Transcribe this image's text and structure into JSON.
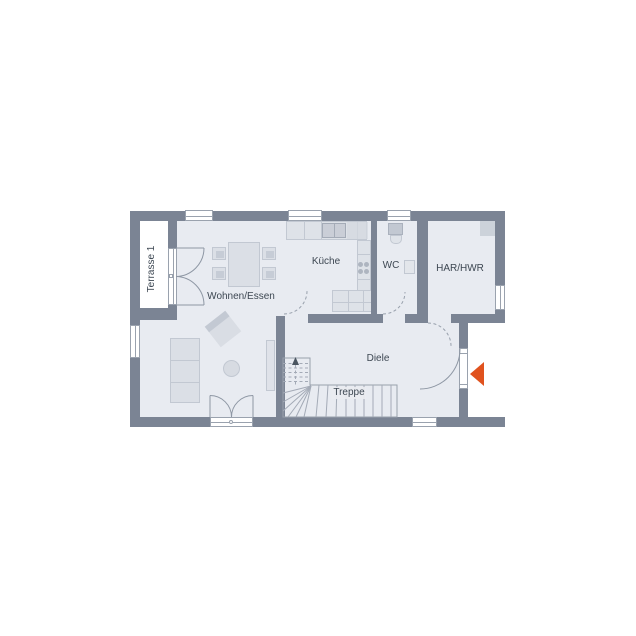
{
  "plan": {
    "type": "floor-plan",
    "labels": {
      "terrace": "Terrasse 1",
      "living_dining": "Wohnen/Essen",
      "kitchen": "Küche",
      "wc": "WC",
      "utility": "HAR/HWR",
      "hallway": "Diele",
      "stairs": "Treppe"
    },
    "colors": {
      "wall": "#7b8494",
      "floor": "#e8ebf1",
      "outside": "#ffffff",
      "furniture": "#dbdfe6",
      "furniture_dark": "#c2c8d2",
      "line": "#9aa2ae",
      "label": "#3d4752",
      "entrance_arrow": "#e0521e"
    }
  }
}
